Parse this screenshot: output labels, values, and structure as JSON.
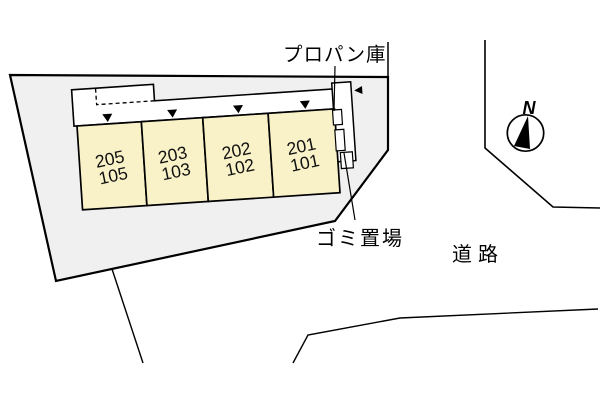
{
  "plan": {
    "type": "site-plan",
    "labels": {
      "propane": "プロパン庫",
      "garbage": "ゴミ置場",
      "road": "道路",
      "north": "N"
    },
    "units": [
      {
        "upper": "205",
        "lower": "105"
      },
      {
        "upper": "203",
        "lower": "103"
      },
      {
        "upper": "202",
        "lower": "102"
      },
      {
        "upper": "201",
        "lower": "101"
      }
    ],
    "icons": {
      "entrance_marker": "down-triangle-icon",
      "stair_marker": "left-triangle-icon",
      "compass": "compass-north-icon"
    },
    "colors": {
      "site_fill": "#f0f0f0",
      "unit_fill": "#f9f2c8",
      "line": "#000000",
      "white": "#ffffff"
    }
  }
}
